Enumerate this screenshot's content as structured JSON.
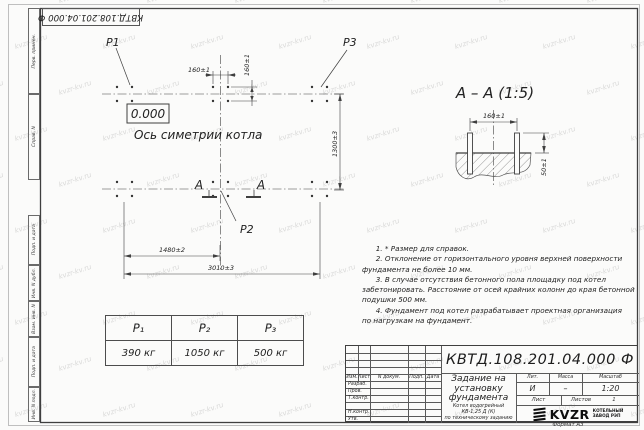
{
  "watermark": {
    "text": "kvzr-kv.ru"
  },
  "frame": {
    "margin_labels": [
      "Перв. примен.",
      "Справ. N",
      "Подп. и дата",
      "Инв. N дубл.",
      "Взам. инв. N",
      "Подп. и дата",
      "Инв. N подл."
    ],
    "corner_stamp": "КВТД.108.201.04.000 Ф",
    "format_label": "Формат А3"
  },
  "plan": {
    "p1_label": "P1",
    "p2_label": "P2",
    "p3_label": "P3",
    "elevation": "0.000",
    "axis_label": "Ось симетрии котла",
    "dims": {
      "bolt_spacing_x": "160±1",
      "bolt_spacing_y": "160±1",
      "row_spacing": "1300±3",
      "left_to_axis": "1480±2",
      "overall": "3010±3"
    },
    "section_letter_left": "А",
    "section_letter_right": "А"
  },
  "section": {
    "title": "А – А (1:5)",
    "dims": {
      "bolt_spacing": "160±1",
      "protrusion": "50±1"
    }
  },
  "loads_table": {
    "headers": [
      "P₁",
      "P₂",
      "P₃"
    ],
    "values": [
      "390 кг",
      "1050 кг",
      "500 кг"
    ]
  },
  "notes": {
    "lines": [
      "      1. * Размер для справок.",
      "      2. Отклонение от горизонтального уровня верхней поверхности",
      "фундамента не более 10 мм.",
      "      3. В случае отсутствия бетонного пола площадку под котел",
      "забетонировать. Расстояние от осей крайних колонн до края бетонной",
      "подушки 500 мм.",
      "      4. Фундамент под котел разрабатывает проектная организация",
      "по нагрузкам на фундамент."
    ]
  },
  "title_block": {
    "designation": "КВТД.108.201.04.000 Ф",
    "doc_title_lines": [
      "Задание на",
      "установку",
      "фундамента"
    ],
    "product_lines": [
      "Котел водогрейный",
      "КВ-1,25 Д (К)",
      "по техническому заданию"
    ],
    "change_header": {
      "izm": "Изм.",
      "list": "Лист",
      "doc": "N докум.",
      "podp": "Подп.",
      "data": "Дата"
    },
    "sign_rows": [
      "Разраб.",
      "Пров.",
      "Т.контр.",
      "Н.контр.",
      "Утв."
    ],
    "lit": {
      "header": "Лит.",
      "value": "И"
    },
    "mass": {
      "header": "Масса",
      "value": "–"
    },
    "scale": {
      "header": "Масштаб",
      "value": "1:20"
    },
    "sheet": {
      "label": "Лист",
      "of_label": "Листов",
      "of_value": "1"
    },
    "company": {
      "logo": "KVZR",
      "name_line1": "КОТЕЛЬНЫЙ",
      "name_line2": "ЗАВОД РЭП"
    }
  }
}
